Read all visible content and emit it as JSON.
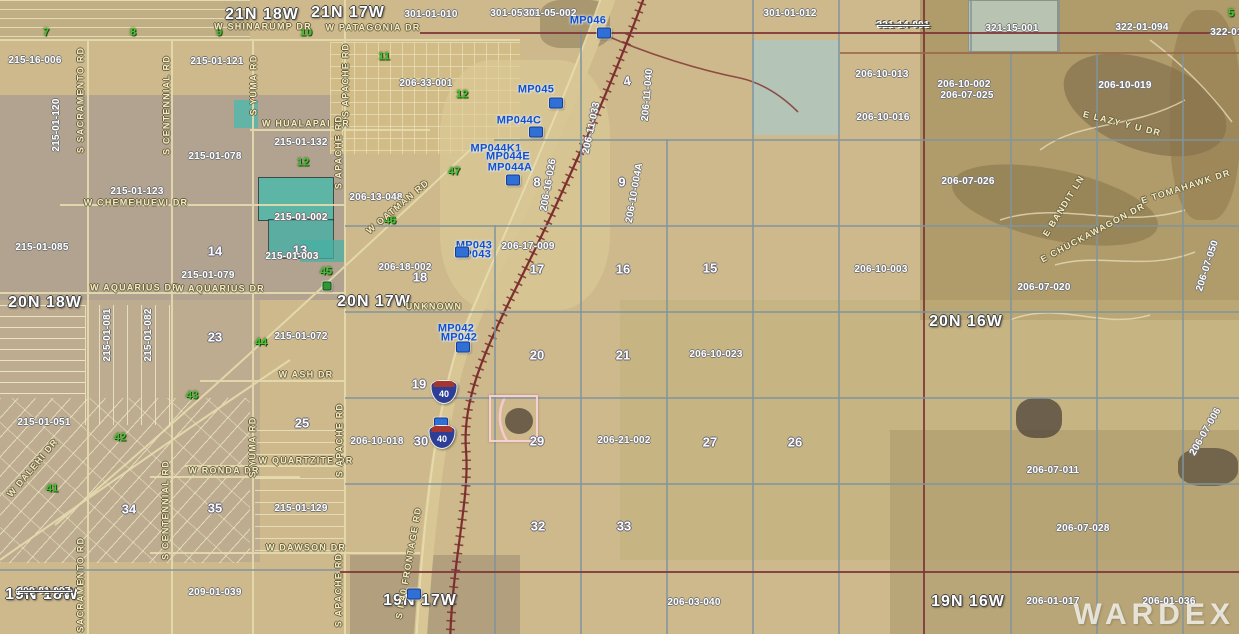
{
  "map": {
    "watermark": "WARDEX"
  },
  "palette": {
    "terrain_tan": "#cdb98c",
    "terrain_gray": "#a99c90",
    "mountain_brown": "#a5915f",
    "teal_parcel": "#4fb9ab",
    "milepost_blue": "#1450c8",
    "section_green": "#46c430",
    "railroad_maroon": "#7d2f2f",
    "road_cream": "#e6dcae",
    "highlight_pink": "#f9d1d8"
  },
  "labels": [
    {
      "t": "21N 18W",
      "x": 262,
      "y": 15,
      "c": "twp"
    },
    {
      "t": "21N 17W",
      "x": 348,
      "y": 13,
      "c": "twp"
    },
    {
      "t": "20N 18W",
      "x": 45,
      "y": 303,
      "c": "twp"
    },
    {
      "t": "20N 17W",
      "x": 374,
      "y": 302,
      "c": "twp"
    },
    {
      "t": "20N 16W",
      "x": 966,
      "y": 322,
      "c": "twp"
    },
    {
      "t": "19N 18W",
      "x": 42,
      "y": 595,
      "c": "twp"
    },
    {
      "t": "19N 17W",
      "x": 420,
      "y": 601,
      "c": "twp"
    },
    {
      "t": "19N 16W",
      "x": 968,
      "y": 602,
      "c": "twp"
    },
    {
      "t": "4",
      "x": 627,
      "y": 81,
      "c": "sec",
      "r": -10
    },
    {
      "t": "8",
      "x": 537,
      "y": 182,
      "c": "sec"
    },
    {
      "t": "9",
      "x": 622,
      "y": 182,
      "c": "sec"
    },
    {
      "t": "13",
      "x": 300,
      "y": 250,
      "c": "sec"
    },
    {
      "t": "14",
      "x": 215,
      "y": 251,
      "c": "sec"
    },
    {
      "t": "15",
      "x": 710,
      "y": 268,
      "c": "sec"
    },
    {
      "t": "16",
      "x": 623,
      "y": 269,
      "c": "sec"
    },
    {
      "t": "17",
      "x": 537,
      "y": 269,
      "c": "sec"
    },
    {
      "t": "18",
      "x": 420,
      "y": 277,
      "c": "sec"
    },
    {
      "t": "19",
      "x": 419,
      "y": 384,
      "c": "sec"
    },
    {
      "t": "20",
      "x": 537,
      "y": 355,
      "c": "sec"
    },
    {
      "t": "21",
      "x": 623,
      "y": 355,
      "c": "sec"
    },
    {
      "t": "23",
      "x": 215,
      "y": 337,
      "c": "sec"
    },
    {
      "t": "25",
      "x": 302,
      "y": 423,
      "c": "sec"
    },
    {
      "t": "26",
      "x": 795,
      "y": 442,
      "c": "sec"
    },
    {
      "t": "27",
      "x": 710,
      "y": 442,
      "c": "sec"
    },
    {
      "t": "29",
      "x": 537,
      "y": 441,
      "c": "sec"
    },
    {
      "t": "30",
      "x": 421,
      "y": 441,
      "c": "sec"
    },
    {
      "t": "32",
      "x": 538,
      "y": 526,
      "c": "sec"
    },
    {
      "t": "33",
      "x": 624,
      "y": 526,
      "c": "sec"
    },
    {
      "t": "34",
      "x": 129,
      "y": 509,
      "c": "sec"
    },
    {
      "t": "35",
      "x": 215,
      "y": 508,
      "c": "sec"
    },
    {
      "t": "7",
      "x": 46,
      "y": 33,
      "c": "secg"
    },
    {
      "t": "8",
      "x": 133,
      "y": 33,
      "c": "secg"
    },
    {
      "t": "9",
      "x": 219,
      "y": 33,
      "c": "secg"
    },
    {
      "t": "10",
      "x": 306,
      "y": 33,
      "c": "secg"
    },
    {
      "t": "11",
      "x": 384,
      "y": 57,
      "c": "secg"
    },
    {
      "t": "5",
      "x": 1231,
      "y": 14,
      "c": "secg"
    },
    {
      "t": "12",
      "x": 462,
      "y": 95,
      "c": "secg"
    },
    {
      "t": "12",
      "x": 303,
      "y": 163,
      "c": "secg"
    },
    {
      "t": "45",
      "x": 326,
      "y": 272,
      "c": "secg"
    },
    {
      "t": "44",
      "x": 261,
      "y": 343,
      "c": "secg"
    },
    {
      "t": "46",
      "x": 390,
      "y": 221,
      "c": "secg"
    },
    {
      "t": "47",
      "x": 454,
      "y": 172,
      "c": "secg"
    },
    {
      "t": "43",
      "x": 192,
      "y": 396,
      "c": "secg"
    },
    {
      "t": "42",
      "x": 120,
      "y": 438,
      "c": "secg"
    },
    {
      "t": "41",
      "x": 52,
      "y": 489,
      "c": "secg"
    },
    {
      "t": "215-16-006",
      "x": 35,
      "y": 61,
      "c": "par"
    },
    {
      "t": "215-01-121",
      "x": 217,
      "y": 62,
      "c": "par"
    },
    {
      "t": "301-01-010",
      "x": 431,
      "y": 15,
      "c": "par"
    },
    {
      "t": "301-05-00",
      "x": 514,
      "y": 14,
      "c": "par"
    },
    {
      "t": "301-05-002",
      "x": 550,
      "y": 14,
      "c": "par"
    },
    {
      "t": "301-01-012",
      "x": 790,
      "y": 14,
      "c": "par"
    },
    {
      "t": "321-14-001",
      "x": 903,
      "y": 26,
      "c": "par struck"
    },
    {
      "t": "321-15-001",
      "x": 1012,
      "y": 29,
      "c": "par"
    },
    {
      "t": "322-01-094",
      "x": 1142,
      "y": 28,
      "c": "par"
    },
    {
      "t": "322-01-09",
      "x": 1234,
      "y": 33,
      "c": "par"
    },
    {
      "t": "206-33-001",
      "x": 426,
      "y": 84,
      "c": "par"
    },
    {
      "t": "206-10-013",
      "x": 882,
      "y": 75,
      "c": "par"
    },
    {
      "t": "206-10-002",
      "x": 964,
      "y": 85,
      "c": "par"
    },
    {
      "t": "206-10-019",
      "x": 1125,
      "y": 86,
      "c": "par"
    },
    {
      "t": "206-07-025",
      "x": 967,
      "y": 96,
      "c": "par"
    },
    {
      "t": "206-10-016",
      "x": 883,
      "y": 118,
      "c": "par"
    },
    {
      "t": "206-11-040",
      "x": 648,
      "y": 95,
      "c": "par",
      "r": -85
    },
    {
      "t": "206-11-033",
      "x": 592,
      "y": 128,
      "c": "par",
      "r": -78
    },
    {
      "t": "215-01-132",
      "x": 301,
      "y": 143,
      "c": "par"
    },
    {
      "t": "215-01-078",
      "x": 215,
      "y": 157,
      "c": "par"
    },
    {
      "t": "215-01-123",
      "x": 137,
      "y": 192,
      "c": "par"
    },
    {
      "t": "215-01-120",
      "x": 57,
      "y": 125,
      "c": "par",
      "r": -90
    },
    {
      "t": "215-01-002",
      "x": 301,
      "y": 218,
      "c": "par"
    },
    {
      "t": "206-13-048",
      "x": 376,
      "y": 198,
      "c": "par"
    },
    {
      "t": "206-16-026",
      "x": 549,
      "y": 185,
      "c": "par",
      "r": -80
    },
    {
      "t": "206-10-004A",
      "x": 635,
      "y": 193,
      "c": "par",
      "r": -80
    },
    {
      "t": "206-07-026",
      "x": 968,
      "y": 182,
      "c": "par"
    },
    {
      "t": "215-01-085",
      "x": 42,
      "y": 248,
      "c": "par"
    },
    {
      "t": "215-01-003",
      "x": 292,
      "y": 257,
      "c": "par"
    },
    {
      "t": "206-17-009",
      "x": 528,
      "y": 247,
      "c": "par"
    },
    {
      "t": "215-01-079",
      "x": 208,
      "y": 276,
      "c": "par"
    },
    {
      "t": "206-18-002",
      "x": 405,
      "y": 268,
      "c": "par"
    },
    {
      "t": "206-10-003",
      "x": 881,
      "y": 270,
      "c": "par"
    },
    {
      "t": "206-07-020",
      "x": 1044,
      "y": 288,
      "c": "par"
    },
    {
      "t": "206-07-050",
      "x": 1208,
      "y": 266,
      "c": "par",
      "r": -72
    },
    {
      "t": "215-01-081",
      "x": 108,
      "y": 335,
      "c": "par",
      "r": -90
    },
    {
      "t": "215-01-082",
      "x": 149,
      "y": 335,
      "c": "par",
      "r": -90
    },
    {
      "t": "215-01-072",
      "x": 301,
      "y": 337,
      "c": "par"
    },
    {
      "t": "206-10-023",
      "x": 716,
      "y": 355,
      "c": "par"
    },
    {
      "t": "215-01-051",
      "x": 44,
      "y": 423,
      "c": "par"
    },
    {
      "t": "206-10-018",
      "x": 377,
      "y": 442,
      "c": "par"
    },
    {
      "t": "206-21-002",
      "x": 624,
      "y": 441,
      "c": "par"
    },
    {
      "t": "206-07-006",
      "x": 1206,
      "y": 432,
      "c": "par",
      "r": -60
    },
    {
      "t": "206-07-011",
      "x": 1053,
      "y": 471,
      "c": "par"
    },
    {
      "t": "215-01-129",
      "x": 301,
      "y": 509,
      "c": "par"
    },
    {
      "t": "206-07-028",
      "x": 1083,
      "y": 529,
      "c": "par"
    },
    {
      "t": "209-01-039",
      "x": 215,
      "y": 593,
      "c": "par"
    },
    {
      "t": "209-01-097",
      "x": 44,
      "y": 592,
      "c": "par struck"
    },
    {
      "t": "206-03-040",
      "x": 694,
      "y": 603,
      "c": "par"
    },
    {
      "t": "206-01-017",
      "x": 1053,
      "y": 602,
      "c": "par"
    },
    {
      "t": "206-01-036",
      "x": 1169,
      "y": 602,
      "c": "par"
    },
    {
      "t": "W SHINARUMP DR",
      "x": 263,
      "y": 27,
      "c": "road"
    },
    {
      "t": "W PATAGONIA DR",
      "x": 373,
      "y": 28,
      "c": "road"
    },
    {
      "t": "W HUALAPAI DR",
      "x": 306,
      "y": 124,
      "c": "road"
    },
    {
      "t": "W CHEMEHUEVI DR",
      "x": 136,
      "y": 203,
      "c": "road"
    },
    {
      "t": "W AQUARIUS DR",
      "x": 135,
      "y": 288,
      "c": "road"
    },
    {
      "t": "W AQUARIUS DR",
      "x": 220,
      "y": 289,
      "c": "road"
    },
    {
      "t": "UNKNOWN",
      "x": 434,
      "y": 307,
      "c": "road"
    },
    {
      "t": "W ASH DR",
      "x": 306,
      "y": 375,
      "c": "road"
    },
    {
      "t": "W QUARTZITE DR",
      "x": 306,
      "y": 461,
      "c": "road"
    },
    {
      "t": "W RONDA DR",
      "x": 224,
      "y": 471,
      "c": "road"
    },
    {
      "t": "W DAWSON DR",
      "x": 306,
      "y": 548,
      "c": "road"
    },
    {
      "t": "W OATMAN RD",
      "x": 398,
      "y": 207,
      "c": "road",
      "r": -40
    },
    {
      "t": "W DALEHI DR",
      "x": 33,
      "y": 468,
      "c": "road",
      "r": -50
    },
    {
      "t": "S YUMA RD",
      "x": 254,
      "y": 85,
      "c": "road",
      "r": -90
    },
    {
      "t": "S YUMA RD",
      "x": 253,
      "y": 447,
      "c": "road",
      "r": -90
    },
    {
      "t": "S APACHE RD",
      "x": 346,
      "y": 80,
      "c": "road",
      "r": -90
    },
    {
      "t": "S APACHE RD",
      "x": 339,
      "y": 152,
      "c": "road",
      "r": -90
    },
    {
      "t": "S APACHE RD",
      "x": 340,
      "y": 440,
      "c": "road",
      "r": -90
    },
    {
      "t": "S APACHE RD",
      "x": 339,
      "y": 590,
      "c": "road",
      "r": -90
    },
    {
      "t": "S SACRAMENTO RD",
      "x": 81,
      "y": 100,
      "c": "road",
      "r": -90
    },
    {
      "t": "S SACRAMENTO RD",
      "x": 81,
      "y": 590,
      "c": "road",
      "r": -90
    },
    {
      "t": "S CENTENNIAL RD",
      "x": 167,
      "y": 105,
      "c": "road",
      "r": -90
    },
    {
      "t": "S CENTENNIAL RD",
      "x": 166,
      "y": 510,
      "c": "road",
      "r": -90
    },
    {
      "t": "S I-40 FRONTAGE RD",
      "x": 409,
      "y": 563,
      "c": "road",
      "r": -80
    },
    {
      "t": "E TOMAHAWK DR",
      "x": 1186,
      "y": 187,
      "c": "road",
      "r": -18
    },
    {
      "t": "E BANDIT LN",
      "x": 1064,
      "y": 206,
      "c": "road",
      "r": -58
    },
    {
      "t": "E CHUCKAWAGON DR",
      "x": 1093,
      "y": 233,
      "c": "road",
      "r": -28
    },
    {
      "t": "E LAZY Y U DR",
      "x": 1122,
      "y": 124,
      "c": "road",
      "r": 14
    },
    {
      "t": "MP046",
      "x": 588,
      "y": 21,
      "c": "mp"
    },
    {
      "t": "MP045",
      "x": 536,
      "y": 90,
      "c": "mp"
    },
    {
      "t": "MP044C",
      "x": 519,
      "y": 121,
      "c": "mp"
    },
    {
      "t": "MP044K1",
      "x": 496,
      "y": 149,
      "c": "mp"
    },
    {
      "t": "MP044E",
      "x": 508,
      "y": 157,
      "c": "mp"
    },
    {
      "t": "MP044A",
      "x": 510,
      "y": 168,
      "c": "mp"
    },
    {
      "t": "MP043",
      "x": 474,
      "y": 246,
      "c": "mp"
    },
    {
      "t": "MP043",
      "x": 473,
      "y": 255,
      "c": "mp"
    },
    {
      "t": "MP042",
      "x": 456,
      "y": 329,
      "c": "mp"
    },
    {
      "t": "MP042",
      "x": 459,
      "y": 338,
      "c": "mp"
    }
  ],
  "markers": [
    {
      "x": 604,
      "y": 33,
      "k": "mp"
    },
    {
      "x": 556,
      "y": 103,
      "k": "mp"
    },
    {
      "x": 536,
      "y": 132,
      "k": "mp"
    },
    {
      "x": 513,
      "y": 180,
      "k": "mp"
    },
    {
      "x": 462,
      "y": 252,
      "k": "mp"
    },
    {
      "x": 463,
      "y": 347,
      "k": "mp"
    },
    {
      "x": 441,
      "y": 423,
      "k": "mp"
    },
    {
      "x": 414,
      "y": 594,
      "k": "mp"
    },
    {
      "x": 327,
      "y": 286,
      "k": "green"
    }
  ],
  "shields": [
    {
      "t": "40",
      "x": 444,
      "y": 392
    },
    {
      "t": "40",
      "x": 442,
      "y": 437
    }
  ],
  "grid": {
    "v": [
      {
        "x": 494,
        "y1": 225,
        "y2": 634,
        "cl": "g"
      },
      {
        "x": 580,
        "y1": 30,
        "y2": 634,
        "cl": "g"
      },
      {
        "x": 666,
        "y1": 139,
        "y2": 634,
        "cl": "g"
      },
      {
        "x": 752,
        "y1": 0,
        "y2": 634,
        "cl": "g"
      },
      {
        "x": 838,
        "y1": 0,
        "y2": 634,
        "cl": "g"
      },
      {
        "x": 923,
        "y1": 0,
        "y2": 634,
        "cl": "m"
      },
      {
        "x": 970,
        "y1": 0,
        "y2": 52,
        "cl": "g"
      },
      {
        "x": 1058,
        "y1": 0,
        "y2": 52,
        "cl": "g"
      },
      {
        "x": 1010,
        "y1": 52,
        "y2": 634,
        "cl": "g"
      },
      {
        "x": 1096,
        "y1": 52,
        "y2": 634,
        "cl": "g"
      },
      {
        "x": 1182,
        "y1": 52,
        "y2": 634,
        "cl": "g"
      }
    ],
    "h": [
      {
        "y": 32,
        "x1": 420,
        "x2": 1239,
        "cl": "m"
      },
      {
        "y": 52,
        "x1": 840,
        "x2": 1239,
        "cl": "b"
      },
      {
        "y": 139,
        "x1": 494,
        "x2": 1239,
        "cl": "g"
      },
      {
        "y": 225,
        "x1": 345,
        "x2": 1239,
        "cl": "g"
      },
      {
        "y": 311,
        "x1": 345,
        "x2": 1239,
        "cl": "g"
      },
      {
        "y": 397,
        "x1": 345,
        "x2": 1239,
        "cl": "g"
      },
      {
        "y": 483,
        "x1": 345,
        "x2": 1239,
        "cl": "g"
      },
      {
        "y": 569,
        "x1": 0,
        "x2": 340,
        "cl": "g"
      },
      {
        "y": 571,
        "x1": 340,
        "x2": 1239,
        "cl": "m"
      }
    ]
  },
  "highlight": {
    "x": 489,
    "y": 395,
    "w": 49,
    "h": 47
  }
}
